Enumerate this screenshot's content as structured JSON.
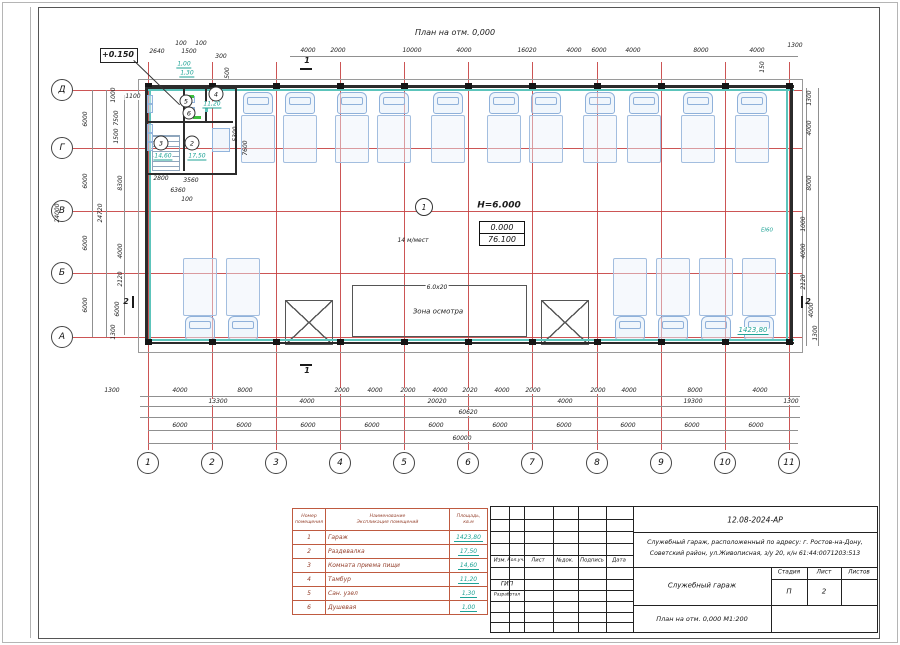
{
  "colors": {
    "accent_teal": "#1fa396",
    "grid_red": "#c74343",
    "table_red": "#bf5a40",
    "car_blue": "#92b4dc"
  },
  "plan": {
    "title": "План на отм. 0,000",
    "level_mark": "+0.150",
    "height": "Н=6.000",
    "level_top": "0.000",
    "level_bottom": "76.100",
    "capacity": "14 м/мест",
    "zone_label": "Зона осмотра",
    "zone_size": "6.0х20",
    "garage_area": "1423,80",
    "door_tag": "EI60",
    "areas": {
      "r2": "17,50",
      "r3": "14,60",
      "r4": "11,20",
      "r5": "1,30",
      "r6": "1,00"
    }
  },
  "axes": {
    "cols": [
      "1",
      "2",
      "3",
      "4",
      "5",
      "6",
      "7",
      "8",
      "9",
      "10",
      "11"
    ],
    "rows": [
      "Д",
      "Г",
      "В",
      "Б",
      "А"
    ]
  },
  "rooms": {
    "n1": "1",
    "n2": "2",
    "n3": "3",
    "n4": "4",
    "n5": "5",
    "n6": "6"
  },
  "sections": {
    "s1": "1",
    "s2": "2"
  },
  "dims": {
    "top": [
      "4000",
      "2000",
      "10000",
      "4000",
      "16020",
      "4000",
      "6000",
      "4000",
      "8000",
      "4000",
      "1300"
    ],
    "small": [
      "2640",
      "100",
      "1500",
      "100",
      "300",
      "500",
      "1100",
      "2800",
      "3560",
      "6360",
      "100",
      "7600",
      "5300",
      "150"
    ],
    "b1": [
      "1300",
      "4000",
      "8000",
      "2000",
      "4000",
      "2000",
      "4000",
      "2020",
      "4000",
      "2000",
      "2000",
      "4000",
      "8000",
      "4000"
    ],
    "b2": [
      "13300",
      "4000",
      "20020",
      "4000",
      "19300",
      "1300"
    ],
    "b3": "60620",
    "b4": [
      "6000",
      "6000",
      "6000",
      "6000",
      "6000",
      "6000",
      "6000",
      "6000",
      "6000",
      "6000"
    ],
    "b5": "60000",
    "left": [
      "24000",
      "6000",
      "6000",
      "6000",
      "6000",
      "24720",
      "1000",
      "7500",
      "1500",
      "8300",
      "4000",
      "2120",
      "6000",
      "1300"
    ],
    "right": [
      "1300",
      "4000",
      "8000",
      "1000",
      "4000",
      "2120",
      "4000",
      "1300"
    ]
  },
  "schedule": {
    "h_num": "Номер помещения",
    "h_name1": "Наименование",
    "h_name2": "Экспликация помещений",
    "h_area1": "Площадь,",
    "h_area2": "кв.м",
    "rows": [
      {
        "n": "1",
        "name": "Гараж",
        "area": "1423,80"
      },
      {
        "n": "2",
        "name": "Раздевалка",
        "area": "17,50"
      },
      {
        "n": "3",
        "name": "Комната приема пищи",
        "area": "14,60"
      },
      {
        "n": "4",
        "name": "Тамбур",
        "area": "11,20"
      },
      {
        "n": "5",
        "name": "Сан. узел",
        "area": "1,30"
      },
      {
        "n": "6",
        "name": "Душевая",
        "area": "1,00"
      }
    ]
  },
  "stamp": {
    "doc_code": "12.08-2024-АР",
    "address_line1": "Служебный гараж,  расположенный по адресу: г. Ростов-на-Дону,",
    "address_line2": "Советский район, ул.Живописная, з/у 20, к/н 61:44:0071203:513",
    "cols": [
      "Изм.",
      "Кол.уч.",
      "Лист",
      "№док.",
      "Подпись",
      "Дата"
    ],
    "role1": "ГИП",
    "role2": "Разработал",
    "project": "Служебный гараж",
    "stage_label": "Стадия",
    "sheet_label": "Лист",
    "sheets_label": "Листов",
    "stage": "П",
    "sheet_num": "2",
    "sheets_total": "",
    "sheet_title": "План на отм. 0,000 М1:200"
  }
}
